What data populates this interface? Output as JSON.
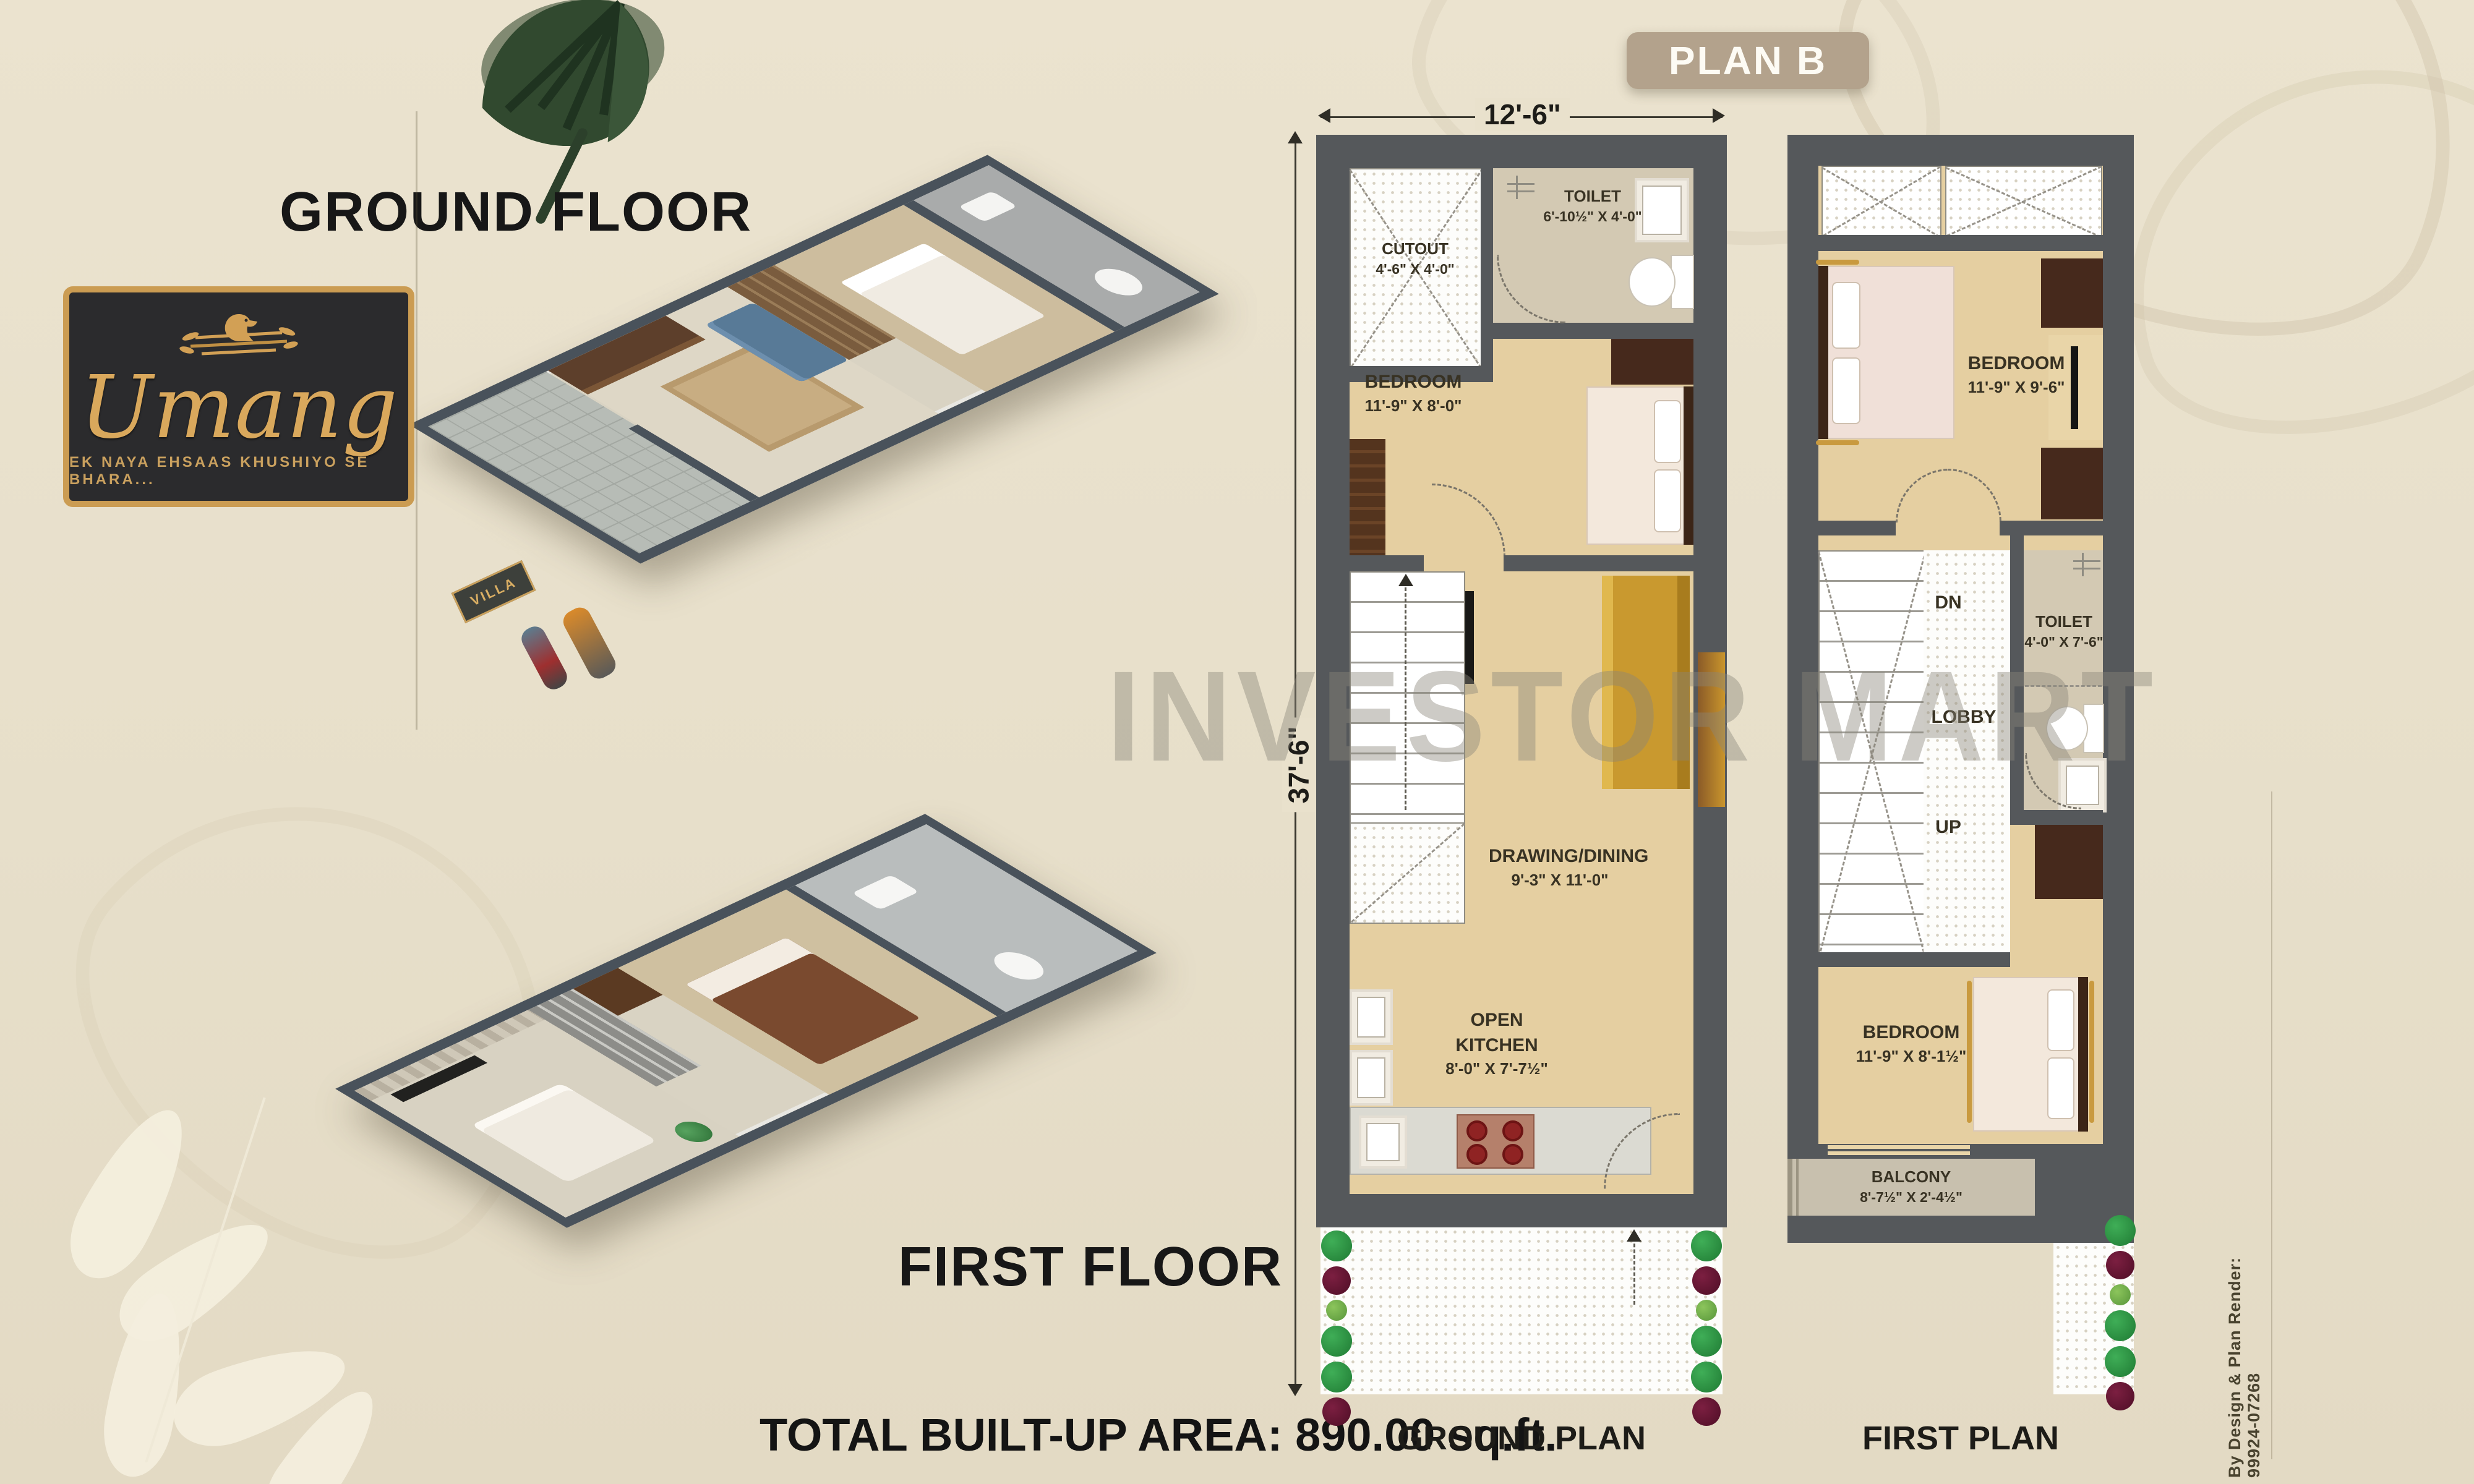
{
  "header": {
    "plan_badge": "PLAN B"
  },
  "branding": {
    "logo_name": "Umang",
    "logo_tagline": "EK NAYA EHSAAS KHUSHIYO SE BHARA...",
    "logo_icon": "bird-nest-icon"
  },
  "floor_labels": {
    "ground": "GROUND FLOOR",
    "first": "FIRST FLOOR"
  },
  "render_ground": {
    "villa_sign": "VILLA"
  },
  "watermark": "INVESTOR MART",
  "footer": {
    "total_area": "TOTAL BUILT-UP AREA: 890.00 sq.ft."
  },
  "credit": "By Design & Plan Render: 99924-07268",
  "ground_plan": {
    "caption": "GROUND PLAN",
    "dim_width": "12'-6\"",
    "dim_height": "37'-6\"",
    "cutout": {
      "name": "CUTOUT",
      "dim": "4'-6\" X 4'-0\""
    },
    "toilet": {
      "name": "TOILET",
      "dim": "6'-10½\" X 4'-0\""
    },
    "bedroom": {
      "name": "BEDROOM",
      "dim": "11'-9\" X 8'-0\""
    },
    "drawing": {
      "name": "DRAWING/DINING",
      "dim": "9'-3\" X 11'-0\""
    },
    "kitchen": {
      "name": "OPEN KITCHEN",
      "dim": "8'-0\" X 7'-7½\""
    }
  },
  "first_plan": {
    "caption": "FIRST PLAN",
    "bedroom_top": {
      "name": "BEDROOM",
      "dim": "11'-9\" X 9'-6\""
    },
    "toilet": {
      "name": "TOILET",
      "dim": "4'-0\" X 7'-6\""
    },
    "lobby": "LOBBY",
    "dn": "DN",
    "up": "UP",
    "bedroom_bottom": {
      "name": "BEDROOM",
      "dim": "11'-9\" X 8'-1½\""
    },
    "balcony": {
      "name": "BALCONY",
      "dim": "8'-7½\" X 2'-4½\""
    }
  },
  "colors": {
    "page_bg": "#e8e0cb",
    "badge_bg": "#b3a28c",
    "wall": "#55585b",
    "floor_tan": "#e5cfa1",
    "gold": "#cb9c52",
    "logo_bg": "#2b2b2d",
    "plant_green": "#2f9748",
    "plant_maroon": "#5f1330",
    "watermark_gray": "#8a867a"
  }
}
